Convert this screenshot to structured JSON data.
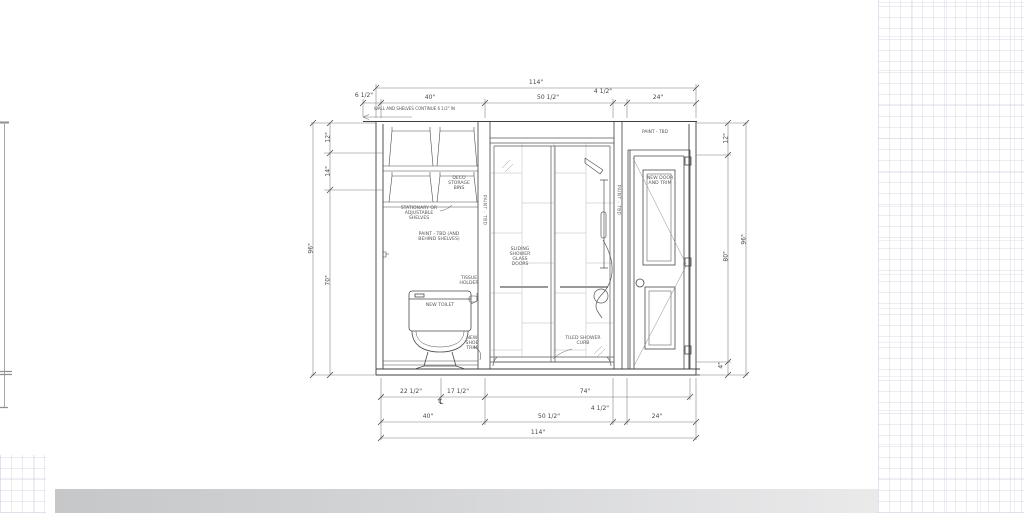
{
  "dims": {
    "top": {
      "overall": "114\"",
      "segs": [
        "6 1/2\"",
        "40\"",
        "50 1/2\"",
        "4 1/2\"",
        "24\""
      ]
    },
    "bottom": {
      "row1": [
        "22 1/2\"",
        "17 1/2\"",
        "74\""
      ],
      "centerline": "℄",
      "row2": [
        "40\"",
        "50 1/2\"",
        "4 1/2\"",
        "24\""
      ],
      "overall": "114\""
    },
    "left": {
      "overall": "96\"",
      "segs": [
        "12\"",
        "14\"",
        "70\""
      ]
    },
    "right": {
      "overall": "96\"",
      "segs": [
        "12\"",
        "80\"",
        "4\""
      ]
    }
  },
  "labels": {
    "wall_note": "WALL AND SHELVES CONTINUE 6 1/2\" IN",
    "deco_bins": "DECO STORAGE BINS",
    "shelves": "STATIONARY OR ADJUSTABLE SHELVES",
    "paint_behind": "PAINT - TBD (AND BEHIND SHELVES)",
    "tissue": "TISSUE HOLDER",
    "toilet": "NEW TOILET",
    "shoe_trim": "NEW SHOE TRIM",
    "sliding_doors": "SLIDING SHOWER GLASS DOORS",
    "curb": "TILED SHOWER CURB",
    "paint_wall": "PAINT - TBD",
    "door": "NEW DOOR AND TRIM",
    "strip_left": "PAINT - TBD",
    "strip_right": "PAINT - TBD"
  },
  "colors": {
    "line": "#3f3f3f",
    "dim_line": "#777777",
    "tile": "#b8b8b8",
    "band": "#c5c7c9"
  }
}
